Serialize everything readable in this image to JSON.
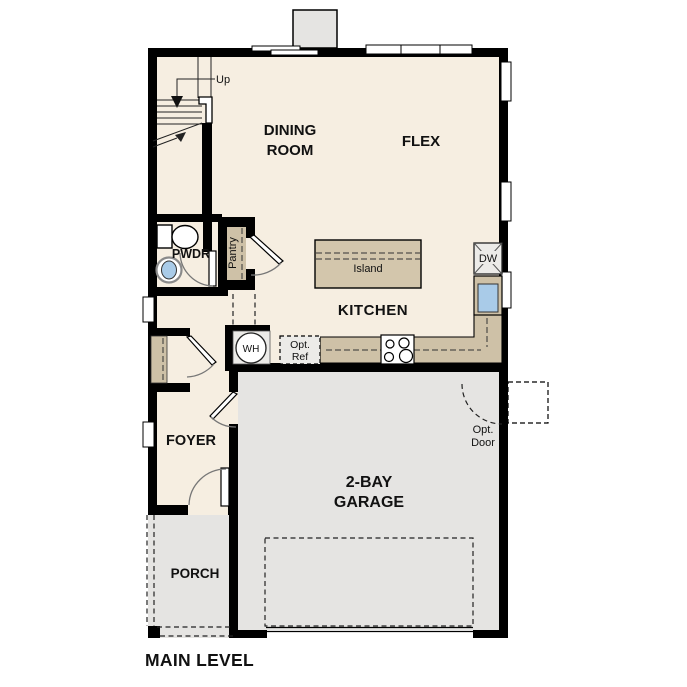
{
  "title": "MAIN LEVEL",
  "rooms": {
    "dining": {
      "line1": "DINING",
      "line2": "ROOM"
    },
    "flex": {
      "label": "FLEX"
    },
    "kitchen": {
      "label": "KITCHEN"
    },
    "pwdr": {
      "label": "PWDR"
    },
    "pantry": {
      "label": "Pantry"
    },
    "foyer": {
      "label": "FOYER"
    },
    "porch": {
      "label": "PORCH"
    },
    "garage": {
      "line1": "2-BAY",
      "line2": "GARAGE"
    }
  },
  "fixtures": {
    "island": "Island",
    "dishwasher": "DW",
    "water_heater": "WH",
    "opt_ref": {
      "line1": "Opt.",
      "line2": "Ref"
    },
    "opt_door": {
      "line1": "Opt.",
      "line2": "Door"
    },
    "stairs_up": "Up"
  },
  "colors": {
    "floor": "#f6eee1",
    "garage": "#e5e4e2",
    "counter": "#cec1a7",
    "island": "#d3c6ac",
    "appliance": "#ecebe8",
    "sink_blue": "#a9cbe8",
    "wall": "#000000"
  }
}
